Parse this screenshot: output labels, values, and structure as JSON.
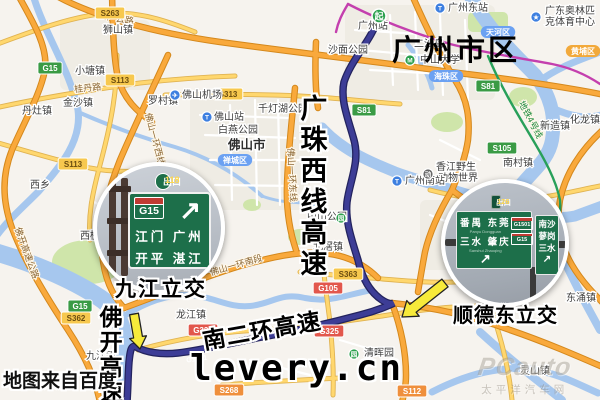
{
  "map": {
    "source_note": "地图来自百度",
    "watermark": {
      "site": "levery.cn",
      "logo": "PCauto",
      "logo_cn": "太平洋汽车网"
    },
    "annotations": {
      "city": "广州市区",
      "expressway_vertical_1": "广珠西线高速",
      "expressway_vertical_2": "佛开高速",
      "expressway_rotated": "南二环高速",
      "interchange_left": "九江立交",
      "interchange_right": "顺德东立交"
    },
    "route": {
      "start_marker": "起",
      "road_code": "G1501"
    },
    "insets": {
      "left": {
        "exit_badge": {
          "label": "出口",
          "number": "118"
        },
        "sign": {
          "code": "G15",
          "dest_row1": "江门 广州",
          "dest_row2": "开平 湛江",
          "arrow": "↗"
        }
      },
      "right": {
        "exit_badge": {
          "label": "出口",
          "number": "126"
        },
        "main_sign": {
          "row1": "番禺 东莞",
          "row1_pinyin": "Panyu Dongguan",
          "row2": "三水 肇庆",
          "row2_pinyin": "Sanshui Zhaoqing",
          "badge1": "G1501",
          "badge2": "G15",
          "arrow": "↗"
        },
        "side_sign": {
          "rows": [
            "南沙",
            "蓼岗",
            "三水"
          ],
          "arrow": "↗"
        }
      }
    },
    "palette": {
      "route": "#3d3d96",
      "highway_orange": "#f9a93c",
      "water": "#a6c7ee",
      "arrow_yellow": "#f7ea3a",
      "sign_green": "#1d6f4a"
    },
    "badge_styles": {
      "gexp": {
        "bg": "#3a9b45",
        "fg": "#ffffff",
        "br": "#ffffff",
        "rx": 2
      },
      "sy": {
        "bg": "#f7c84e",
        "fg": "#6b4d10",
        "br": "#ffffff",
        "rx": 2
      },
      "gr": {
        "bg": "#e2574c",
        "fg": "#ffffff",
        "br": "#ffffff",
        "rx": 2
      },
      "so": {
        "bg": "#ef8f3c",
        "fg": "#ffffff",
        "br": "#ffffff",
        "rx": 2
      },
      "dist": {
        "bg": "#6ba1f2",
        "fg": "#ffffff",
        "br": "none",
        "rx": 6
      },
      "disto": {
        "bg": "#f2a93b",
        "fg": "#ffffff",
        "br": "none",
        "rx": 6
      }
    },
    "road_badges": [
      {
        "t": "G15",
        "x": 50,
        "y": 68,
        "k": "gexp"
      },
      {
        "t": "G15",
        "x": 80,
        "y": 306,
        "k": "gexp"
      },
      {
        "t": "S81",
        "x": 364,
        "y": 110,
        "k": "gexp"
      },
      {
        "t": "S81",
        "x": 488,
        "y": 86,
        "k": "gexp"
      },
      {
        "t": "S105",
        "x": 502,
        "y": 148,
        "k": "gexp"
      },
      {
        "t": "S263",
        "x": 110,
        "y": 13,
        "k": "sy"
      },
      {
        "t": "S113",
        "x": 120,
        "y": 80,
        "k": "sy"
      },
      {
        "t": "S113",
        "x": 73,
        "y": 164,
        "k": "sy"
      },
      {
        "t": "S313",
        "x": 228,
        "y": 94,
        "k": "sy"
      },
      {
        "t": "S363",
        "x": 348,
        "y": 274,
        "k": "sy"
      },
      {
        "t": "S362",
        "x": 76,
        "y": 318,
        "k": "sy"
      },
      {
        "t": "G105",
        "x": 328,
        "y": 288,
        "k": "gr"
      },
      {
        "t": "G325",
        "x": 203,
        "y": 330,
        "k": "gr"
      },
      {
        "t": "G325",
        "x": 329,
        "y": 331,
        "k": "gr"
      },
      {
        "t": "S268",
        "x": 229,
        "y": 390,
        "k": "so"
      },
      {
        "t": "S112",
        "x": 412,
        "y": 391,
        "k": "so"
      },
      {
        "t": "天河区",
        "x": 498,
        "y": 32,
        "k": "dist"
      },
      {
        "t": "海珠区",
        "x": 446,
        "y": 76,
        "k": "dist"
      },
      {
        "t": "禅城区",
        "x": 235,
        "y": 160,
        "k": "dist"
      },
      {
        "t": "黄埔区",
        "x": 583,
        "y": 51,
        "k": "disto"
      }
    ],
    "poi_labels": [
      {
        "t": "狮山镇",
        "x": 103,
        "y": 33
      },
      {
        "t": "小塘镇",
        "x": 75,
        "y": 74
      },
      {
        "t": "金沙镇",
        "x": 63,
        "y": 106
      },
      {
        "t": "丹灶镇",
        "x": 22,
        "y": 114
      },
      {
        "t": "罗村镇",
        "x": 148,
        "y": 104
      },
      {
        "t": "西乡",
        "x": 30,
        "y": 188
      },
      {
        "t": "西樵镇",
        "x": 80,
        "y": 239
      },
      {
        "t": "九江镇",
        "x": 86,
        "y": 359
      },
      {
        "t": "龙江镇",
        "x": 176,
        "y": 318
      },
      {
        "t": "北滘镇",
        "x": 313,
        "y": 250
      },
      {
        "t": "佛山市",
        "x": 228,
        "y": 149,
        "cls": "city"
      },
      {
        "t": "佛山机场",
        "x": 182,
        "y": 98
      },
      {
        "t": "佛山站",
        "x": 214,
        "y": 120
      },
      {
        "t": "白燕公园",
        "x": 218,
        "y": 133
      },
      {
        "t": "千灯湖公园",
        "x": 258,
        "y": 112
      },
      {
        "t": "沙面公园",
        "x": 328,
        "y": 53
      },
      {
        "t": "中山公园",
        "x": 307,
        "y": 220
      },
      {
        "t": "中山大学",
        "x": 420,
        "y": 63
      },
      {
        "t": "二沙岛",
        "x": 414,
        "y": 47
      },
      {
        "t": "广州站",
        "x": 358,
        "y": 29
      },
      {
        "t": "广州东站",
        "x": 448,
        "y": 11
      },
      {
        "t": "广东奥林匹",
        "x": 545,
        "y": 14
      },
      {
        "t": "克体育中心",
        "x": 545,
        "y": 25
      },
      {
        "t": "化龙镇",
        "x": 570,
        "y": 123
      },
      {
        "t": "新造镇",
        "x": 540,
        "y": 129
      },
      {
        "t": "南村镇",
        "x": 503,
        "y": 166
      },
      {
        "t": "香江野生",
        "x": 436,
        "y": 170
      },
      {
        "t": "动物世界",
        "x": 438,
        "y": 181
      },
      {
        "t": "广州南站",
        "x": 405,
        "y": 184
      },
      {
        "t": "东涌镇",
        "x": 566,
        "y": 301
      },
      {
        "t": "灵山镇",
        "x": 520,
        "y": 374
      },
      {
        "t": "清晖园",
        "x": 364,
        "y": 356
      }
    ],
    "icons": [
      {
        "g": "✈",
        "x": 175,
        "y": 95,
        "c": "#3d7fe0",
        "n": "airport-icon"
      },
      {
        "g": "T",
        "x": 207,
        "y": 117,
        "c": "#3d7fe0",
        "n": "train-station-icon"
      },
      {
        "g": "T",
        "x": 440,
        "y": 8,
        "c": "#3d7fe0",
        "n": "train-station-icon"
      },
      {
        "g": "T",
        "x": 397,
        "y": 181,
        "c": "#3d7fe0",
        "n": "train-station-icon"
      },
      {
        "g": "M",
        "x": 410,
        "y": 60,
        "c": "#2ca04e",
        "n": "metro-icon"
      },
      {
        "g": "★",
        "x": 536,
        "y": 17,
        "c": "#3d7fe0",
        "n": "stadium-icon"
      },
      {
        "g": "动",
        "x": 428,
        "y": 174,
        "c": "#666666",
        "n": "zoo-icon"
      },
      {
        "g": "园",
        "x": 354,
        "y": 354,
        "c": "#2ca04e",
        "n": "park-icon"
      },
      {
        "g": "园",
        "x": 341,
        "y": 218,
        "c": "#2ca04e",
        "n": "park-icon"
      }
    ],
    "road_name_labels": [
      {
        "t": "广云路",
        "x": 120,
        "y": 22,
        "r": 10
      },
      {
        "t": "桂丹路",
        "x": 88,
        "y": 91,
        "r": -6
      },
      {
        "t": "佛山一环西线",
        "x": 152,
        "y": 140,
        "r": 75
      },
      {
        "t": "佛山一环东线",
        "x": 289,
        "y": 175,
        "r": 87
      },
      {
        "t": "佛山一环南段",
        "x": 237,
        "y": 268,
        "r": -16
      },
      {
        "t": "佛开高速公路",
        "x": 24,
        "y": 254,
        "r": 70
      },
      {
        "t": "地铁4号线",
        "x": 528,
        "y": 121,
        "r": 62,
        "cls": "metro"
      }
    ]
  }
}
